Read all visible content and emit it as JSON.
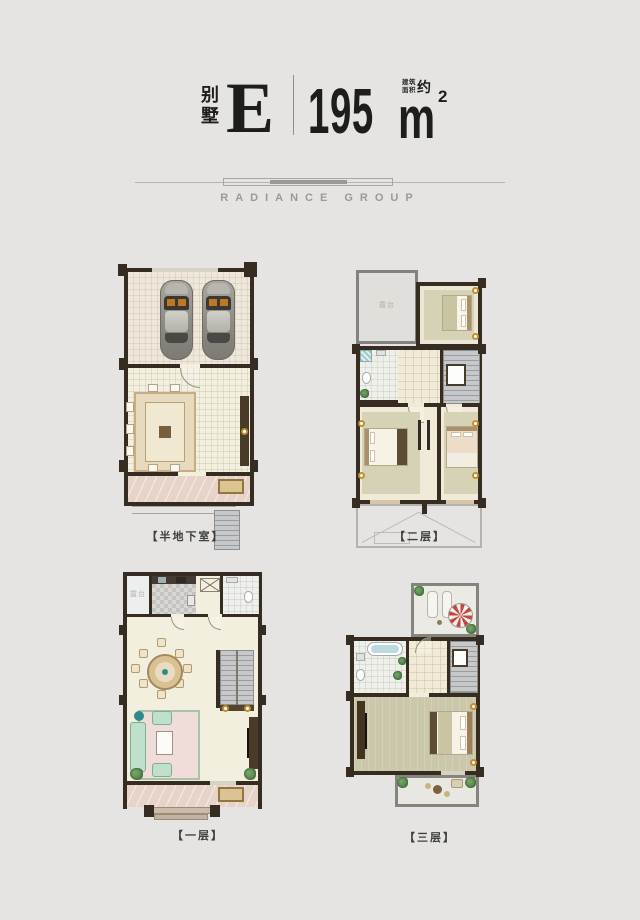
{
  "header": {
    "unit_type_char1": "别",
    "unit_type_char2": "墅",
    "unit_letter": "E",
    "area_value": "195",
    "area_note_line1": "建筑",
    "area_note_line2": "面积",
    "area_approx": "约",
    "area_unit": "m",
    "area_exponent": "2"
  },
  "brand": {
    "name": "RADIANCE GROUP"
  },
  "plans": [
    {
      "id": "semi-basement",
      "label": "【半地下室】"
    },
    {
      "id": "second-floor",
      "label": "【二层】",
      "terrace_note": "露台"
    },
    {
      "id": "first-floor",
      "label": "【一层】",
      "terrace_note": "露台"
    },
    {
      "id": "third-floor",
      "label": "【三层】"
    }
  ],
  "colors": {
    "background": "#e5e4e3",
    "ink": "#1d1d1b",
    "brand_gray": "#9b9a98",
    "wall": "#362c22",
    "floor_cream": "#f3efdf",
    "carpet_sage": "#d6d2b6",
    "porch_marble": "#e7d4c9",
    "stair_gray": "#b4b7ba",
    "sofa_green": "#bfe0ca",
    "rug_pink": "#f0dcd8",
    "parasol_red": "#c5463d",
    "plant_green": "#55804a",
    "lamp_gold": "#c08f2f"
  }
}
